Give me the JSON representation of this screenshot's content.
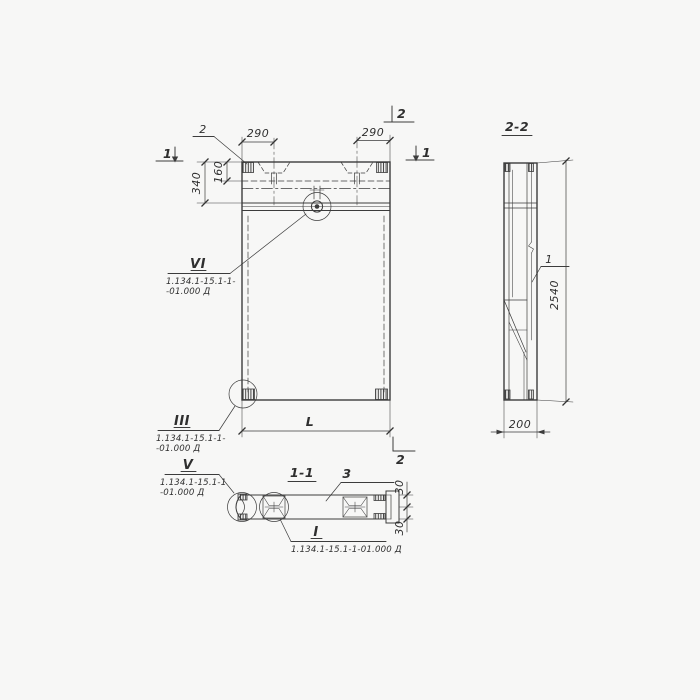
{
  "colors": {
    "paper": "#f7f7f6",
    "ink": "#3c3c3c"
  },
  "elevation": {
    "marker_1_left": "1",
    "marker_1_right": "1",
    "marker_2_top": "2",
    "marker_2_bottom": "2",
    "embed_leader": "2",
    "dim_290_left": "290",
    "dim_290_right": "290",
    "dim_340": "340",
    "dim_160": "160",
    "dim_length": "L",
    "callout_vi": {
      "numeral": "VI",
      "doc_line1": "1.134.1-15.1-1-",
      "doc_line2": "-01.000 Д"
    },
    "callout_iii": {
      "numeral": "III",
      "doc_line1": "1.134.1-15.1-1-",
      "doc_line2": "-01.000 Д"
    }
  },
  "section_2_2": {
    "title": "2-2",
    "part_label": "1",
    "dim_height": "2540",
    "dim_width": "200"
  },
  "section_1_1": {
    "title": "1-1",
    "part_label": "3",
    "dim_30_top": "30",
    "dim_30_bottom": "30",
    "callout_v": {
      "numeral": "V",
      "doc_line1": "1.134.1-15.1-1",
      "doc_line2": "-01.000 Д"
    },
    "callout_i": {
      "numeral": "I",
      "doc_line": "1.134.1-15.1-1-01.000 Д"
    }
  }
}
